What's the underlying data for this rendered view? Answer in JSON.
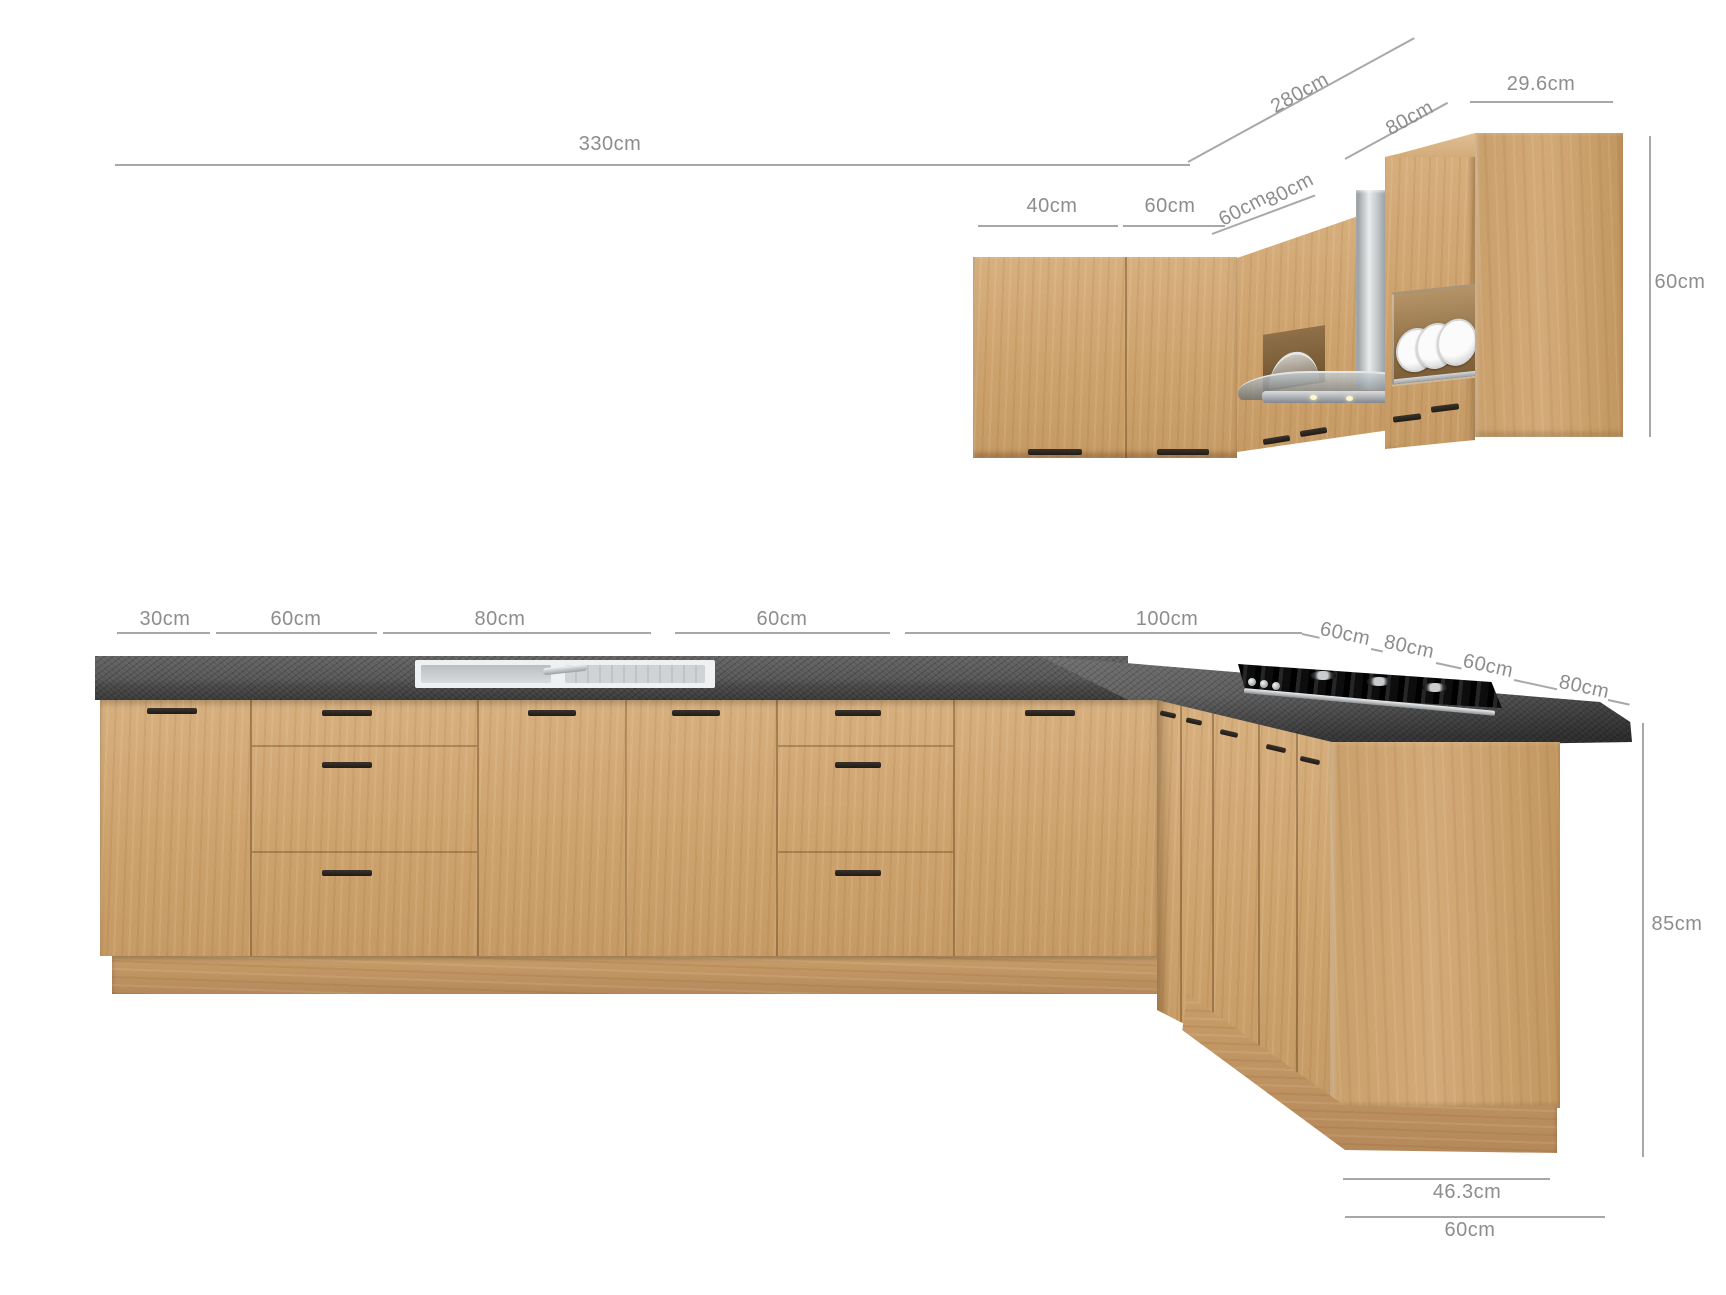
{
  "title": "L-shaped kitchen set dimension diagram",
  "colors": {
    "background": "#ffffff",
    "wood": "#cda26c",
    "wood_light": "#d7b07f",
    "wood_dark": "#b5885a",
    "countertop": "#4a4a4a",
    "steel": "#c9ced1",
    "handle": "#2b2622",
    "dimension_line": "#a8a8a8",
    "dimension_text": "#8d8d8d"
  },
  "dims": {
    "wall_total": "330cm",
    "wall_return": "280cm",
    "upper_return_depth": "80cm",
    "upper_end_width": "29.6cm",
    "upper_door_left": "40cm",
    "upper_door_right": "60cm",
    "upper_corner_left": "60cm",
    "upper_corner_right": "80cm",
    "upper_height": "60cm",
    "base_unit_1": "30cm",
    "base_unit_2": "60cm",
    "base_unit_3": "80cm",
    "base_unit_4": "60cm",
    "base_unit_5": "100cm",
    "return_unit_1": "60cm",
    "return_unit_2": "80cm",
    "return_unit_3": "60cm",
    "return_unit_4": "80cm",
    "base_height": "85cm",
    "end_panel_depth": "46.3cm",
    "end_total_depth": "60cm"
  }
}
